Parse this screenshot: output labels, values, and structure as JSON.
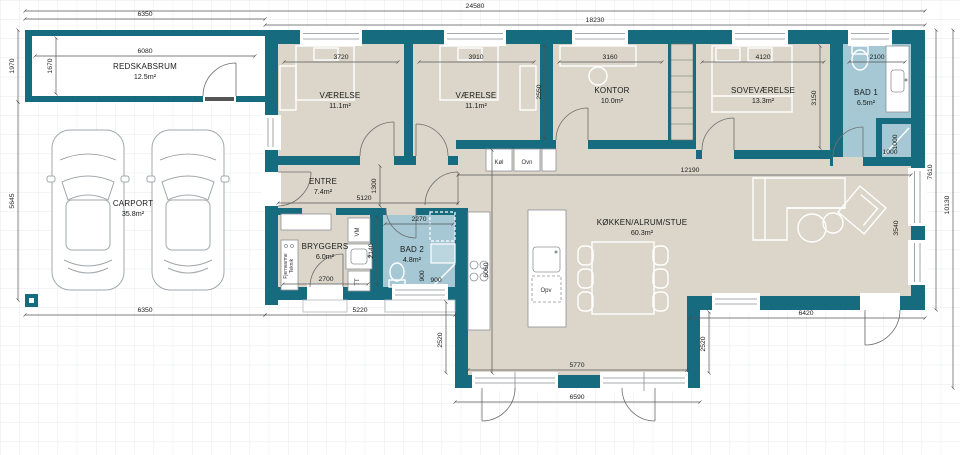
{
  "colors": {
    "wall": "#166b7e",
    "floor": "#dbd6c9",
    "bath": "#a5c8d4",
    "grid": "#e7eaec"
  },
  "rooms": {
    "redskabsrum": {
      "name": "REDSKABSRUM",
      "area": "12.5m²"
    },
    "carport": {
      "name": "CARPORT",
      "area": "35.8m²"
    },
    "vaerelse1": {
      "name": "VÆRELSE",
      "area": "11.1m²"
    },
    "vaerelse2": {
      "name": "VÆRELSE",
      "area": "11.1m²"
    },
    "kontor": {
      "name": "KONTOR",
      "area": "10.0m²"
    },
    "sovevaerelse": {
      "name": "SOVEVÆRELSE",
      "area": "13.3m²"
    },
    "bad1": {
      "name": "BAD 1",
      "area": "6.5m²"
    },
    "entre": {
      "name": "ENTRE",
      "area": "7.4m²"
    },
    "bryggers": {
      "name": "BRYGGERS",
      "area": "6.0m²"
    },
    "bad2": {
      "name": "BAD 2",
      "area": "4.8m²"
    },
    "stue": {
      "name": "KØKKEN/ALRUM/STUE",
      "area": "60.3m²"
    }
  },
  "appliances": {
    "kol": "Køl",
    "ovn": "Ovn",
    "opv": "Opv",
    "vm": "VM",
    "tt": "TT",
    "fjernvarme": "Fjernvarme",
    "teknik": "Teknik"
  },
  "dims": {
    "total": "24580",
    "main": "18230",
    "top_left": "6350",
    "redskab_w": "6080",
    "redskab_h": "1670",
    "redskab_outer": "1970",
    "carport_h": "5645",
    "carport_w": "6350",
    "v1_w": "3720",
    "v2_w": "3910",
    "kontor_w": "3160",
    "sove_w": "4120",
    "bad1_w": "2100",
    "v_d": "2550",
    "sove_d": "3150",
    "bad1_a": "1000",
    "bad1_b": "1000",
    "hall_w": "1300",
    "entre_w": "5120",
    "bryggers_w": "2700",
    "bad2_w": "2270",
    "bad2_d": "2140",
    "bad2_a": "900",
    "bad2_b": "900",
    "kitchen_w": "12190",
    "kitchen_d": "6060",
    "bottom_left": "5220",
    "right_up": "7610",
    "right_total": "10130",
    "win_span": "3540",
    "ext_l": "2520",
    "ext_r": "2520",
    "ext_w": "5770",
    "ext_total": "6590",
    "terrace_w": "6420"
  }
}
